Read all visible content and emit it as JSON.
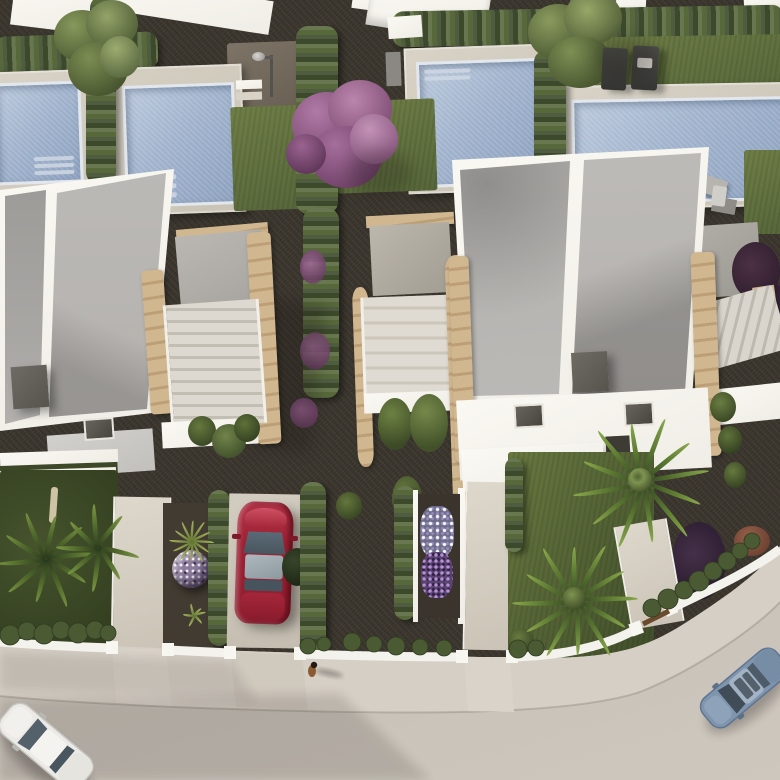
{
  "scene": {
    "title": "Aerial render of modern white villas with pools",
    "objects": [
      "row of white flat-roof villas",
      "four private swimming pools",
      "garden hedges and gravel paths",
      "purple flowering tree",
      "green garden trees",
      "two sun loungers by pool",
      "outdoor pool shower",
      "stone-clad stair towers",
      "red car parked in driveway",
      "white car driving on street",
      "blue car parked at curb",
      "pedestrian walking on sidewalk",
      "palm trees in front gardens",
      "speckled ball plant",
      "white and purple flower beds",
      "curved street with sidewalk"
    ],
    "cars": [
      {
        "name": "red-car",
        "color": "#9c2133",
        "location": "driveway"
      },
      {
        "name": "white-car",
        "color": "#eceae6",
        "location": "street bottom-left"
      },
      {
        "name": "blue-car",
        "color": "#7f94ad",
        "location": "street bottom-right"
      }
    ]
  },
  "palette": {
    "gravel": "#3b362e",
    "gravelLight": "#6d6457",
    "grass": "#57673a",
    "grassLight": "#6f7e46",
    "hedge": "#3c4a2b",
    "hedgeLight": "#57683b",
    "poolWater": "#9fb2cc",
    "deck": "#c9c3b5",
    "white": "#efede6",
    "whiteBright": "#faf8f2",
    "roofGray": "#b4b1ad",
    "roofShade": "#9c9a97",
    "tan": "#d0b78f",
    "tanDark": "#bd9f77",
    "darkBox": "#57544e",
    "street": "#c8c2b9",
    "sidewalk": "#d4cec4",
    "carRed": "#9c2133",
    "carWhite": "#eceae6",
    "carBlue": "#7f94ad",
    "purpleTree": "#96588a"
  }
}
